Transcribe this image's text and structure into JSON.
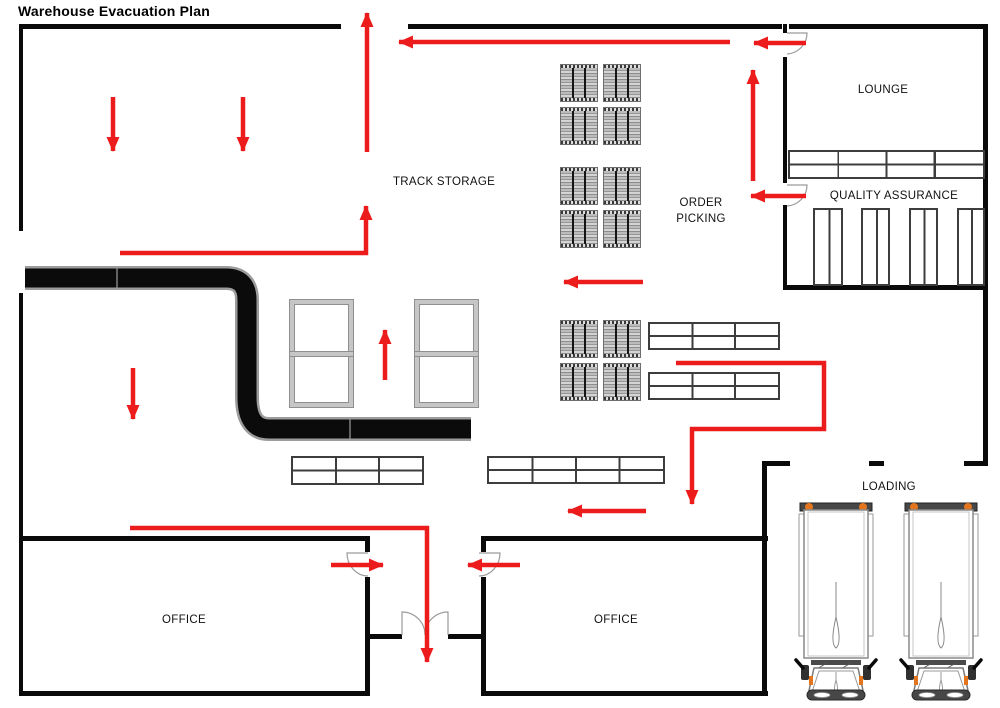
{
  "title": "Warehouse Evacuation Plan",
  "rooms": {
    "lounge": "LOUNGE",
    "quality_assurance": "QUALITY ASSURANCE",
    "track_storage": "TRACK STORAGE",
    "order_picking": "ORDER PICKING",
    "office_left": "OFFICE",
    "office_right": "OFFICE",
    "loading": "LOADING"
  },
  "colors": {
    "evacuation_route": "#ec1c1c",
    "wall": "#0a0a0a",
    "conveyor": "#0b0b0b",
    "conveyor_casing": "#9c9c9c",
    "pallet_fill": "#b5b5b5",
    "rack_frame": "#c6c6c6",
    "truck_accent": "#e2751d",
    "background": "#ffffff"
  }
}
